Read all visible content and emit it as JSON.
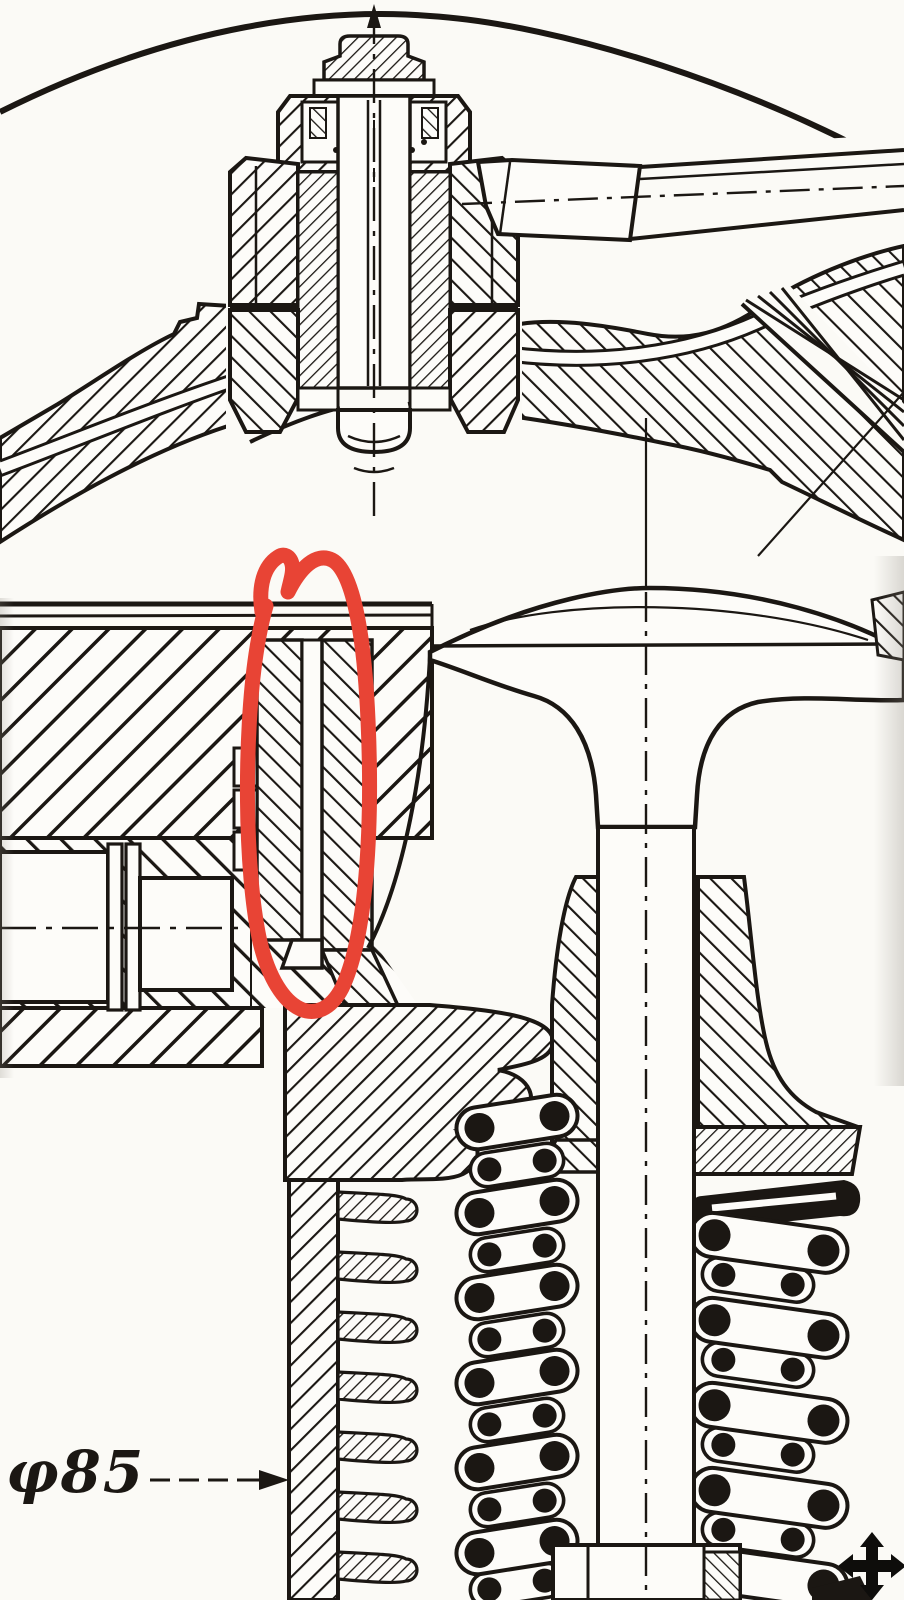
{
  "canvas": {
    "width": 904,
    "height": 1600,
    "paper_color": "#fbfaf6",
    "ink_color": "#1b1713"
  },
  "annotation": {
    "shape": "hand-drawn-ellipse",
    "color": "#e84435"
  },
  "dimension": {
    "label": "φ85"
  },
  "cursor": {
    "icon": "move-cursor",
    "color": "#0e0d0b"
  }
}
